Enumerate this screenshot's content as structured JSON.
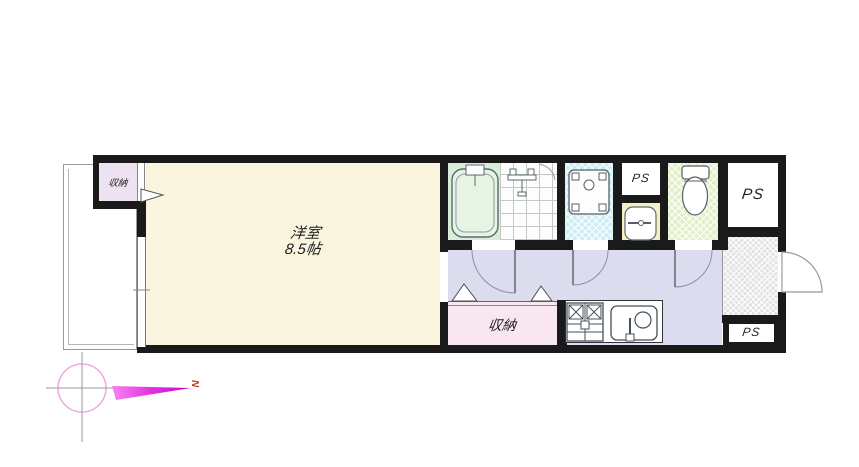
{
  "floorplan": {
    "rooms": {
      "main_room": {
        "name": "洋室",
        "size": "8.5帖"
      },
      "closet_top": {
        "label": "収納"
      },
      "closet_bottom": {
        "label": "収納"
      },
      "pipe_space_top": {
        "label": "PS"
      },
      "pipe_space_right": {
        "label": "PS"
      },
      "pipe_space_bottom": {
        "label": "PS"
      }
    },
    "compass": {
      "north": "N"
    },
    "fixtures": [
      "bathtub-icon",
      "shower-mixer-icon",
      "washing-machine-icon",
      "washbasin-icon",
      "toilet-icon",
      "gas-stove-icon",
      "kitchen-sink-icon",
      "entry-door-swing-icon",
      "interior-door-arc-icon",
      "bifold-closet-door-icon",
      "compass-north-arrow-icon"
    ],
    "colors": {
      "wall": "#1a1a1a",
      "main_room_floor": "#f9f5de",
      "closet_top_floor": "#ece2f1",
      "closet_bottom_floor": "#f8e7f1",
      "corridor_floor": "#dcdcef",
      "bathtub_area": "#d9edd7",
      "washer_area": "#cdeef3",
      "toilet_floor": "#e2efc8",
      "vanity_counter": "#f4f0c4",
      "entry_floor": "#e2e2e2",
      "north_arrow": "#e93fe9",
      "north_letter": "#cc3322"
    }
  }
}
